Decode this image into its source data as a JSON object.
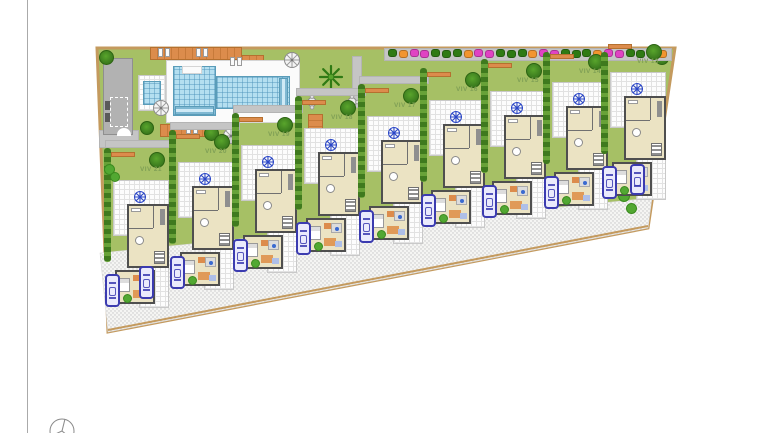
{
  "plan": {
    "type": "residential development site plan",
    "villas": [
      {
        "label": "VIV 21",
        "lx": 140,
        "ly": 172
      },
      {
        "label": "VIV 20",
        "lx": 205,
        "ly": 154
      },
      {
        "label": "VIV 19",
        "lx": 268,
        "ly": 137
      },
      {
        "label": "VIV 18",
        "lx": 331,
        "ly": 120
      },
      {
        "label": "VIV 17",
        "lx": 394,
        "ly": 108
      },
      {
        "label": "VIV 16",
        "lx": 456,
        "ly": 92
      },
      {
        "label": "VIV 15",
        "lx": 517,
        "ly": 83
      },
      {
        "label": "VIV 14",
        "lx": 579,
        "ly": 74
      },
      {
        "label": "VIV 13",
        "lx": 637,
        "ly": 64
      }
    ],
    "amenities": [
      "communal pool",
      "kids pool",
      "pool house",
      "sun decks",
      "umbrellas",
      "seating areas",
      "flower border",
      "street parking"
    ],
    "icons": [
      "umbrella-icon",
      "sunbed-icon",
      "table-chairs-icon",
      "palm-tree-icon",
      "tree-icon",
      "bush-icon",
      "flower-icon",
      "car-icon",
      "terrace-emblem-icon",
      "north-arrow-icon"
    ]
  },
  "colors": {
    "lawn": "#a6c065",
    "boundary": "#c49a5e",
    "water": "#b4dff0",
    "deck_orange": "#dc8c4c",
    "flower_magenta": "#e043c3",
    "flower_orange": "#f2952f",
    "flower_green": "#2f7a14",
    "tree_green": "#3f8020",
    "car_blue": "#3b3bb0",
    "emblem_blue": "#2a46c8",
    "label_green": "#7f9f55",
    "house_floor": "#ebe3c3",
    "wall_gray": "#4f4f4f",
    "road_bg": "#f5f5f3",
    "road_dot": "#c6c6c6"
  }
}
